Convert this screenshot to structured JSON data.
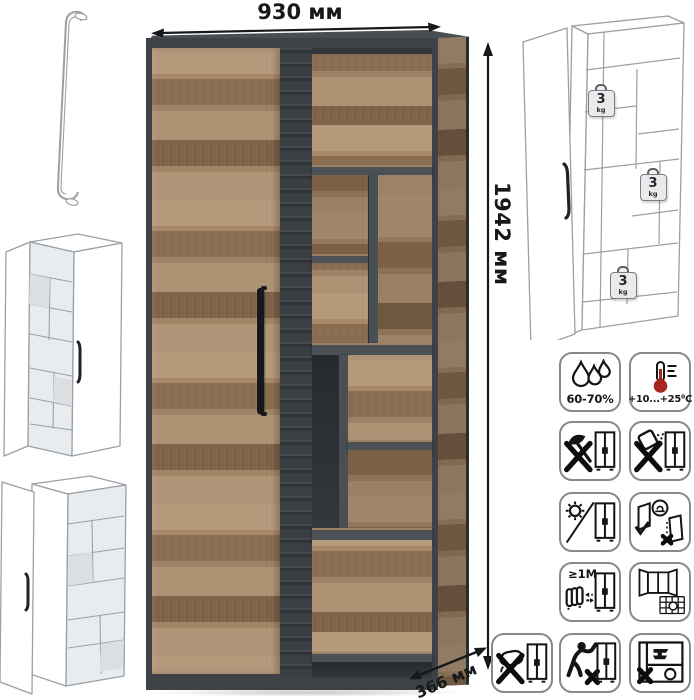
{
  "product": {
    "width_label": "930 мм",
    "height_label": "1942 мм",
    "depth_label": "366 мм",
    "shelf_load": {
      "value": "3",
      "unit": "kg"
    }
  },
  "care": {
    "humidity_label": "60-70%",
    "temperature_label": "+10...+25⁰C",
    "distance_label": "≥1M"
  },
  "colors": {
    "wood": "#a5896a",
    "frame_dark": "#43474c",
    "wireframe_line": "#9aa0a6",
    "thermometer_red": "#a8241e"
  },
  "icons": {
    "row1": [
      "humidity-icon",
      "temperature-icon"
    ],
    "row2": [
      "no-sharp-tools-icon",
      "no-spill-liquids-icon"
    ],
    "row3": [
      "no-direct-sunlight-icon",
      "open-doors-carefully-icon"
    ],
    "row4": [
      "heater-distance-icon",
      "ventilate-room-icon"
    ],
    "row5": [
      "no-abrasive-sponge-icon",
      "no-leaning-icon",
      "no-heavy-objects-on-top-icon"
    ]
  }
}
